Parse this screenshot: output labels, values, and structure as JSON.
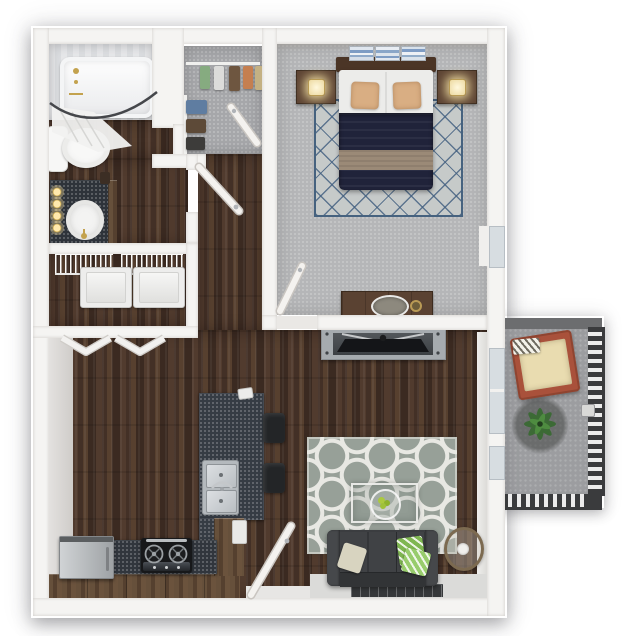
{
  "meta": {
    "view": "top-down 3d apartment floor plan render",
    "canvas": {
      "width": 639,
      "height": 636
    },
    "background": "#ffffff",
    "visible_text": "none"
  },
  "palette": {
    "wall_white": "#f5f4f2",
    "wood_floor": "#46332a",
    "cabinet_wood": "#5e4533",
    "carpet_gray": "#b5b6b8",
    "closet_carpet": "#a6a7aa",
    "granite_counter": "#363c44",
    "stainless": "#b9bcc0",
    "bedding_navy": "#20233a",
    "bed_runner_tan": "#9b8a77",
    "accent_pillow_tan": "#d9ae83",
    "bedroom_rug": "#c6cac9",
    "bedroom_rug_lattice": "#46627f",
    "living_rug": "#97a098",
    "living_rug_motif": "#e8e8e3",
    "sofa_charcoal": "#3b3d40",
    "pillow_green": "#7fb651",
    "pillow_cream": "#d8d4c0",
    "tv_black": "#141518",
    "console_gray": "#a6abaf",
    "balcony_concrete": "#9c9da0",
    "railing_dark": "#3a3b3d",
    "chair_terracotta": "#a9513b",
    "chair_cushion": "#e9dcb0",
    "plant_green": "#3a6a33",
    "fixture_gold": "#c3a24e",
    "lamp_glow": "#ffe9ad"
  },
  "rooms": [
    {
      "name": "bathroom",
      "floor": "wood",
      "items": [
        "bathtub with gold fixtures",
        "curved shower rod with curtain",
        "toilet",
        "vanity with dark counter, white sink, gold faucet, four lit sconces"
      ]
    },
    {
      "name": "walk-in-closet",
      "floor": "carpet",
      "items": [
        "hanging clothes top rail (green, white, brown, orange, tan)",
        "hanging clothes left rail (blue, brown, charcoal)",
        "open swing door"
      ]
    },
    {
      "name": "laundry-closet",
      "floor": "wood",
      "items": [
        "wire shelving",
        "washer",
        "dryer",
        "open bifold doors"
      ]
    },
    {
      "name": "bedroom",
      "floor": "carpet",
      "items": [
        "queen bed with navy duvet and tan runner",
        "two tan accent pillows",
        "wood headboard",
        "three blue art panels",
        "two nightstands with lit lamps",
        "trellis rug",
        "dresser with oval tray and gold knob",
        "window on right wall",
        "swing door"
      ]
    },
    {
      "name": "hallway",
      "floor": "wood",
      "items": [
        "bathroom swing door"
      ]
    },
    {
      "name": "kitchen",
      "floor": "wood",
      "items": [
        "island with granite top and double stainless sink",
        "two black bar stools",
        "stainless refrigerator",
        "black range with two burners",
        "granite base counter",
        "wood cabinets",
        "entry swing door"
      ]
    },
    {
      "name": "living-room",
      "floor": "wood",
      "items": [
        "gray media console with flat TV",
        "quatrefoil gray rug",
        "glass coffee table with green fruit bowl",
        "charcoal sofa with cream and green pillows",
        "round side table",
        "window behind sofa",
        "sliding glass door to balcony"
      ]
    },
    {
      "name": "balcony",
      "floor": "concrete",
      "items": [
        "terracotta lounge chair with cream cushion and striped pillow",
        "potted plant on round pad",
        "metal railing with balusters",
        "gate latch"
      ]
    }
  ]
}
